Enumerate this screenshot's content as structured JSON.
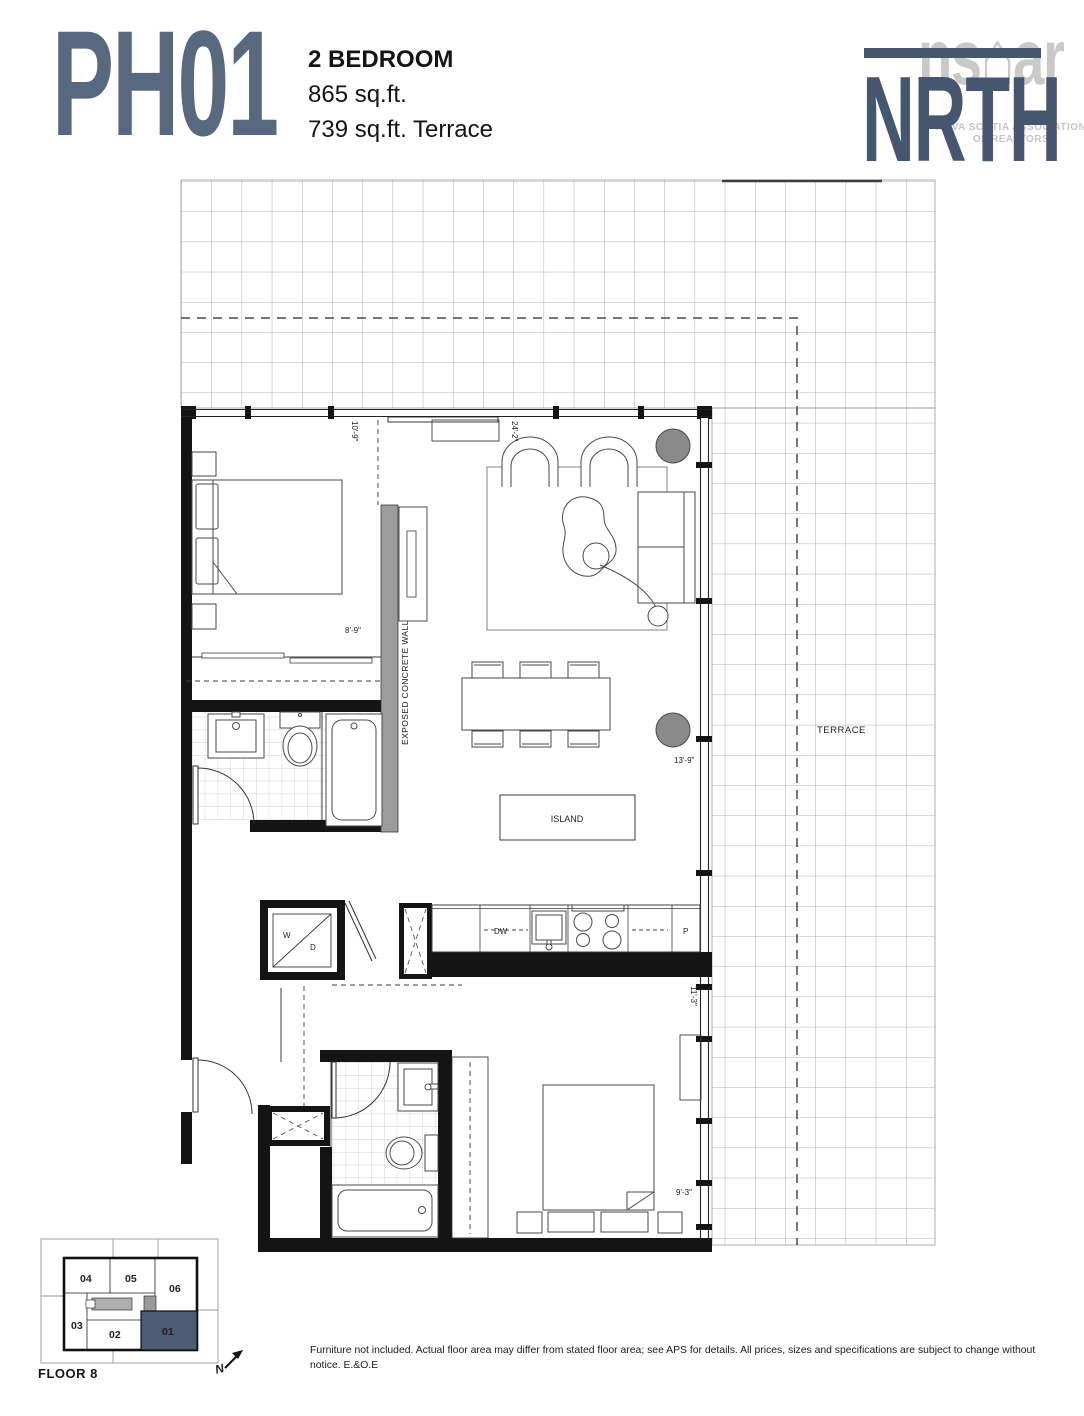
{
  "header": {
    "unit_number": "PH01",
    "unit_type": "2 BEDROOM",
    "interior_area": "865 sq.ft.",
    "terrace_area": "739 sq.ft. Terrace"
  },
  "logo": {
    "brand": "NRTH",
    "watermark_left": "ns",
    "watermark_house": "⌂",
    "watermark_right": "ar",
    "watermark_caption_line1": "NOVA SCOTIA ASSOCIATION",
    "watermark_caption_line2": "OF REALTORS"
  },
  "plan": {
    "room_labels": {
      "terrace": "TERRACE",
      "island": "ISLAND",
      "exposed_concrete_wall": "EXPOSED CONCRETE WALL"
    },
    "appliance_labels": {
      "dishwasher": "DW",
      "pantry": "P",
      "washer": "W",
      "dryer": "D"
    },
    "dimensions": {
      "bedroom1_width": "10'-9\"",
      "living_width": "24'-2\"",
      "bedroom1_depth": "8'-9\"",
      "living_depth": "13'-9\"",
      "bedroom2_width": "11'-3\"",
      "bedroom2_depth": "9'-3\""
    }
  },
  "keyplan": {
    "floor_label": "FLOOR 8",
    "north_label": "N",
    "highlighted_unit": "01",
    "u01": "01",
    "u02": "02",
    "u03": "03",
    "u04": "04",
    "u05": "05",
    "u06": "06"
  },
  "footer": {
    "disclaimer": "Furniture not included. Actual floor area may differ from stated floor area; see APS for details. All prices, sizes and specifications are subject to change without notice. E.&O.E"
  },
  "colors": {
    "accent_slate": "#58697F",
    "logo_blue": "#46566E",
    "keyplan_highlight": "#4C5C74",
    "watermark_gray": "#C9C9C9",
    "wall_black": "#141414",
    "column_gray": "#8A8A8A",
    "concrete_gray": "#9C9C9C"
  }
}
